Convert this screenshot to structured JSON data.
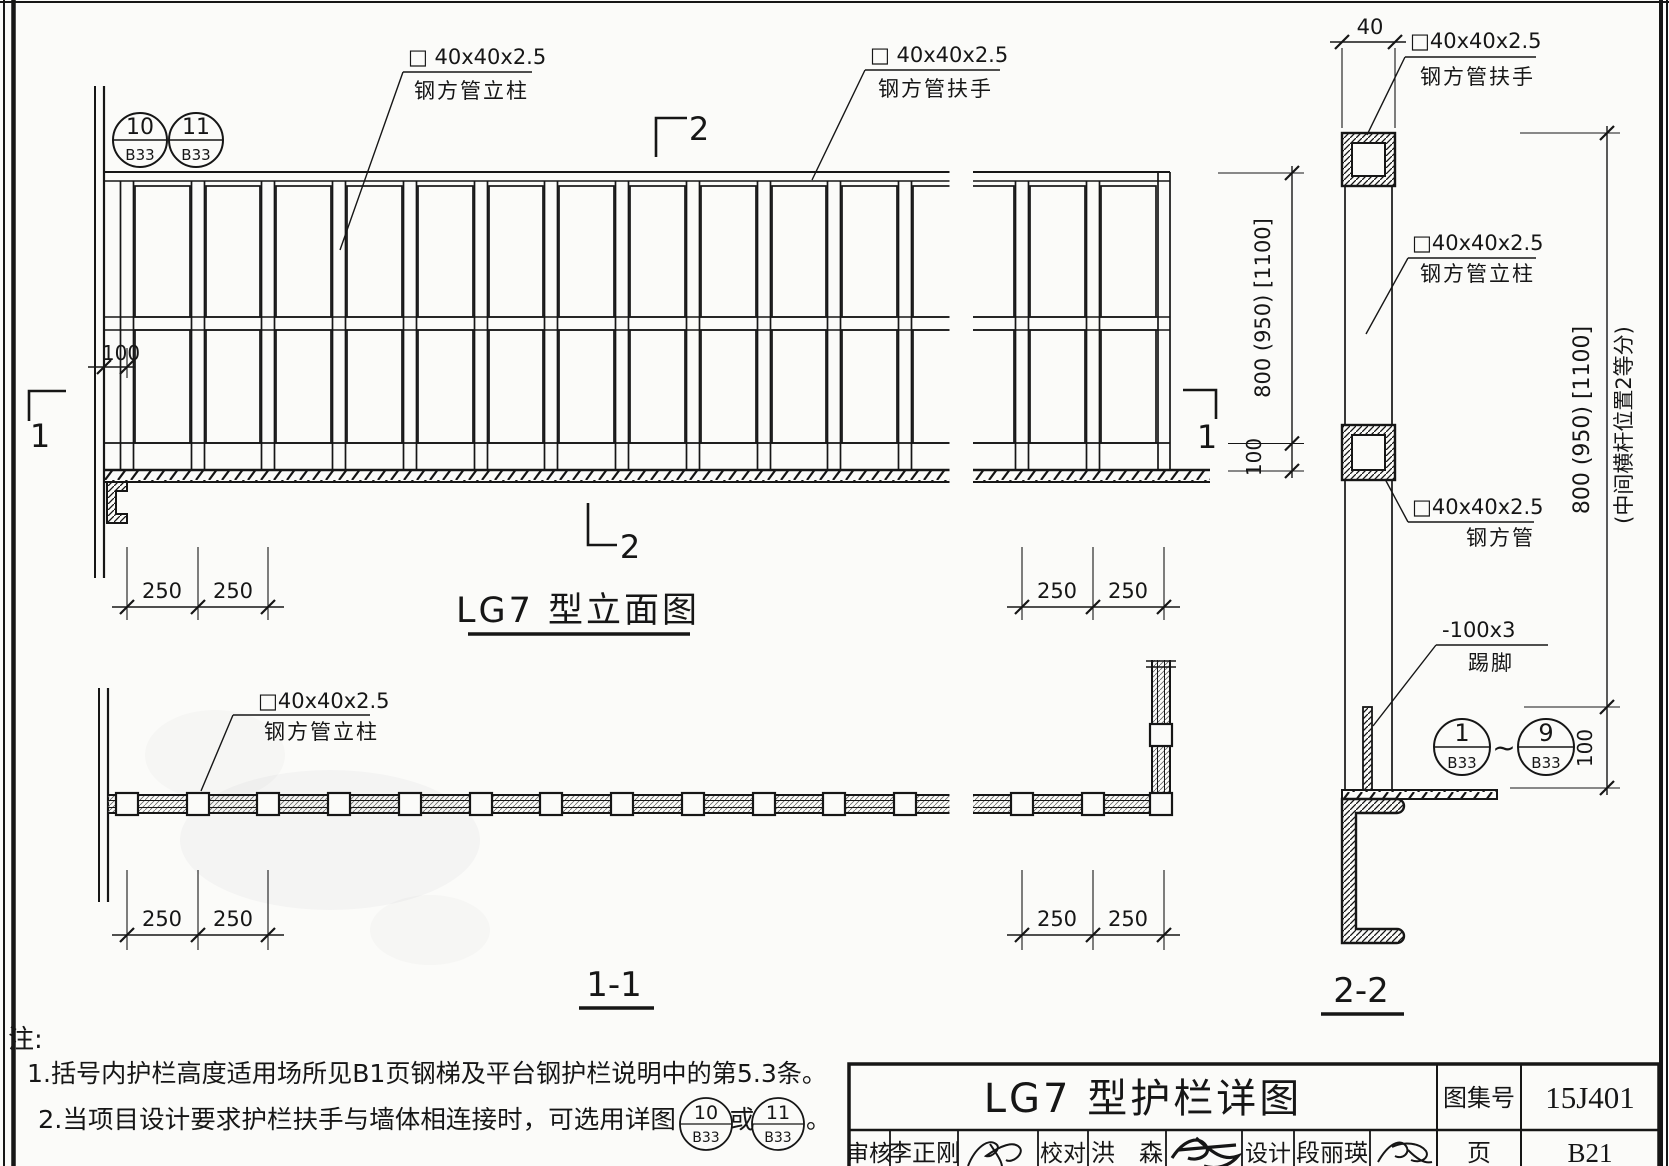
{
  "page": {
    "background": "#fbfbf9",
    "ink": "#161616"
  },
  "callouts": {
    "elev_post": {
      "line1": "□ 40x40x2.5",
      "line2": "钢方管立柱"
    },
    "elev_rail": {
      "line1": "□ 40x40x2.5",
      "line2": "钢方管扶手"
    },
    "plan_post": {
      "line1": "□40x40x2.5",
      "line2": "钢方管立柱"
    },
    "sec_rail": {
      "line1": "□40x40x2.5",
      "line2": "钢方管扶手"
    },
    "sec_post": {
      "line1": "□40x40x2.5",
      "line2": "钢方管立柱"
    },
    "sec_mid": {
      "line1": "□40x40x2.5",
      "line2": "钢方管"
    },
    "sec_toe": {
      "line1": "-100x3",
      "line2": "踢脚"
    }
  },
  "titles": {
    "elevation": "LG7 型立面图",
    "section1": "1-1",
    "section2": "2-2"
  },
  "dims": {
    "d100": "100",
    "d250": "250",
    "d40": "40",
    "height": "800 (950) [1100]",
    "height_note": "(中间横杆位置2等分)"
  },
  "markers": {
    "sec1": "1",
    "sec2": "2",
    "tilde": "~",
    "detail_a": {
      "num": "10",
      "sheet": "B33"
    },
    "detail_b": {
      "num": "11",
      "sheet": "B33"
    },
    "range_from": {
      "num": "1",
      "sheet": "B33"
    },
    "range_to": {
      "num": "9",
      "sheet": "B33"
    }
  },
  "notes": {
    "label": "注:",
    "n1": "1.括号内护栏高度适用场所见B1页钢梯及平台钢护栏说明中的第5.3条。",
    "n2_pre": "2.当项目设计要求护栏扶手与墙体相连接时，可选用详图",
    "n2_or": "或",
    "n2_end": "。",
    "c1": {
      "num": "10",
      "sheet": "B33"
    },
    "c2": {
      "num": "11",
      "sheet": "B33"
    }
  },
  "title_block": {
    "title": "LG7 型护栏详图",
    "atlas_label": "图集号",
    "atlas_no": "15J401",
    "page_label": "页",
    "page_no": "B21",
    "reviewer_label": "审核",
    "reviewer": "李正刚",
    "checker_label": "校对",
    "checker": "洪　森",
    "designer_label": "设计",
    "designer": "段丽瑛"
  },
  "structure": {
    "left_post_xs": [
      127,
      198,
      268,
      339,
      410,
      481,
      551,
      622,
      693,
      764,
      834,
      905
    ],
    "right_post_xs": [
      1022,
      1093
    ],
    "end_post_x": 1164,
    "dim_ticks_left": [
      127,
      198,
      268
    ],
    "dim_ticks_right": [
      1022,
      1093,
      1164
    ]
  }
}
